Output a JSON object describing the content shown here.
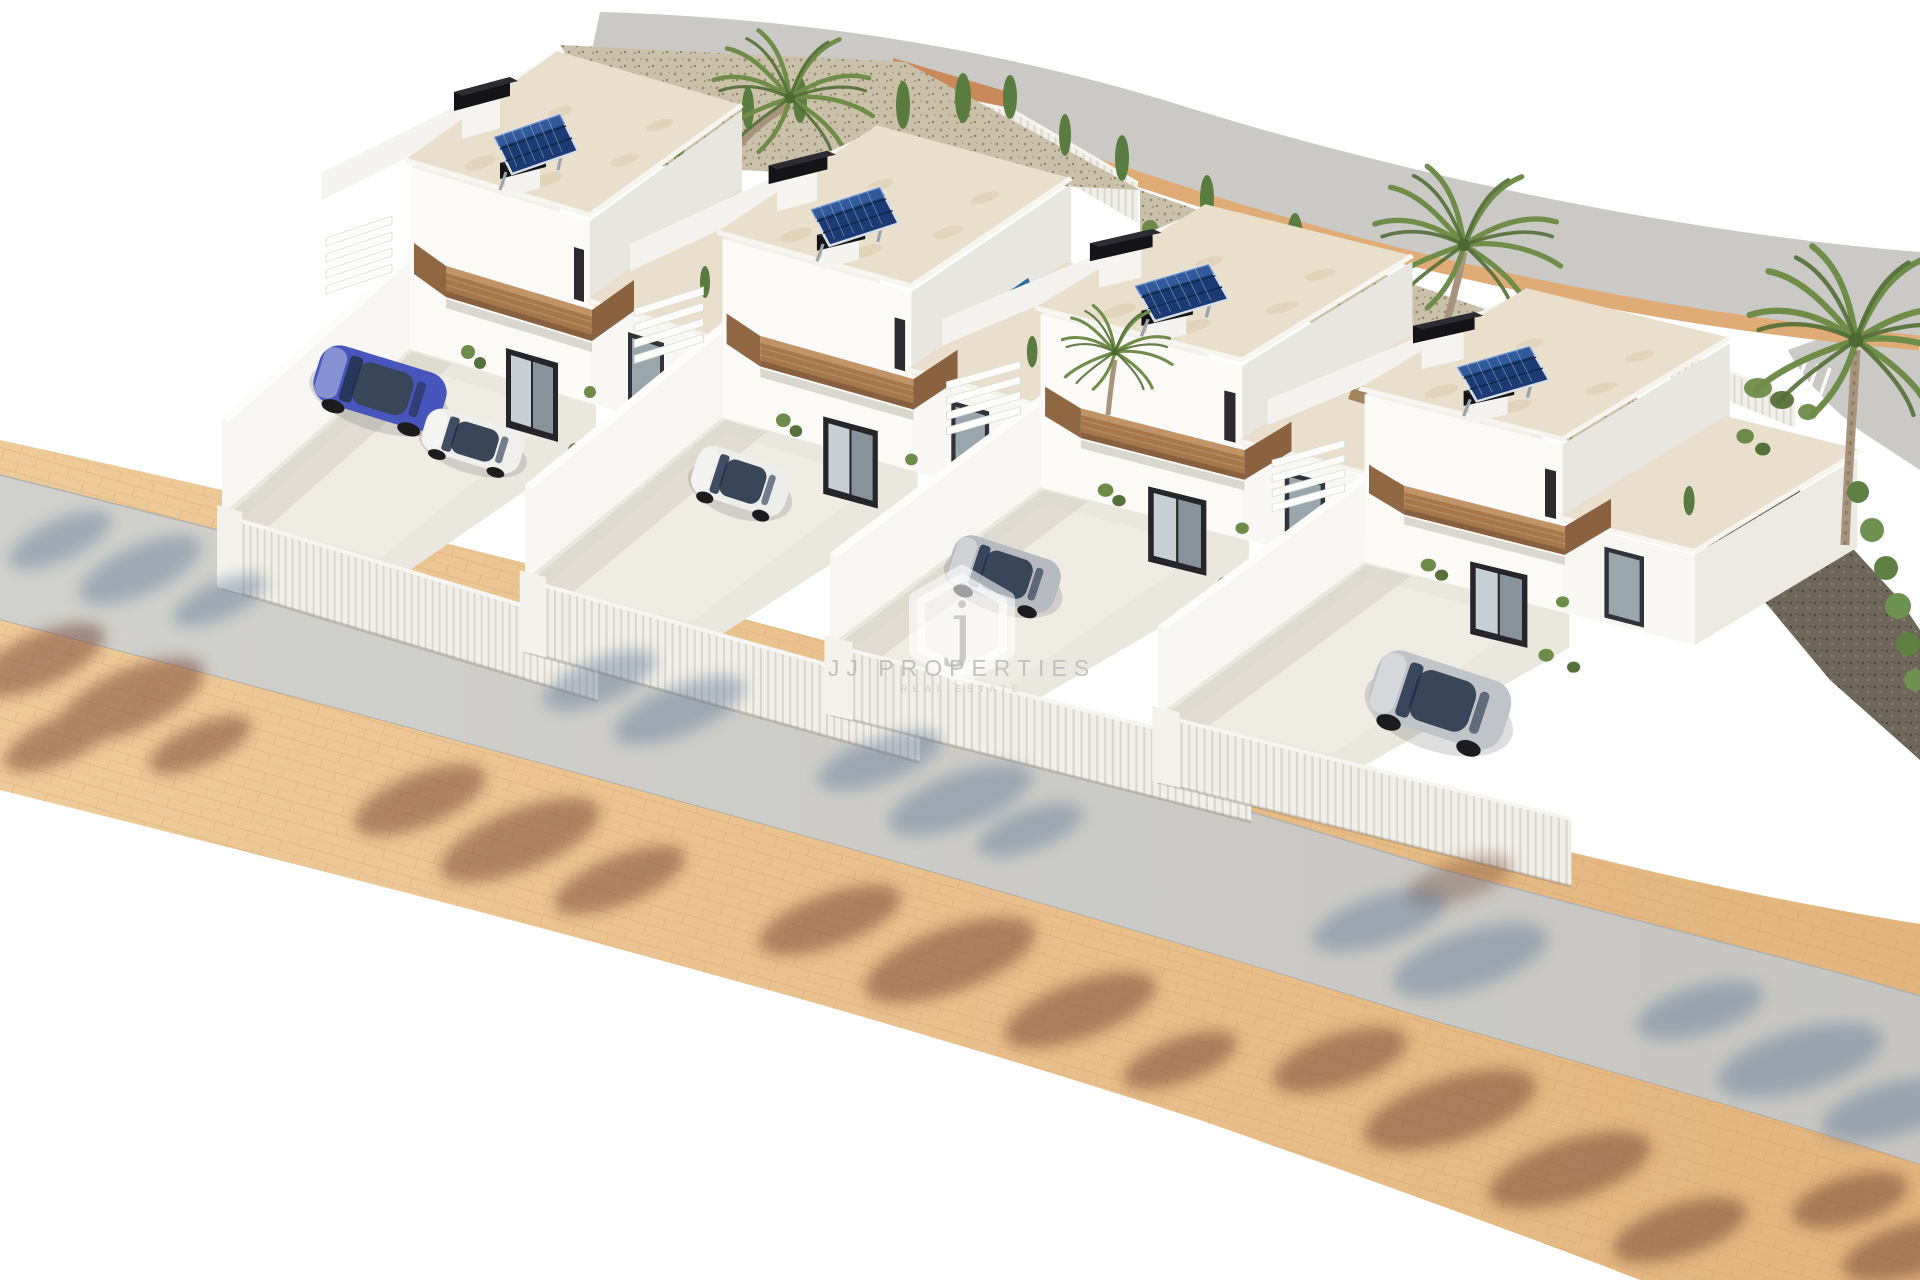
{
  "watermark": {
    "logo_letter": "j",
    "brand": "JJ PROPERTIES",
    "tagline": "REAL ESTATE"
  },
  "scene": {
    "type": "3d-architectural-render",
    "description": "Aerial 3D render of four modern white two-storey villas in a row, each with rooftop solar panels, black chimney caps, wooden balcony bands, private walled courtyards with parked cars, palm trees and gravel gardens; a curved road runs behind and a tan paved sidewalk, asphalt road and second sidewalk with tree shadows cross the foreground",
    "villa_count": 4,
    "solar_panels_per_villa": 1,
    "cars_visible": [
      "blue",
      "white",
      "white",
      "silver",
      "silver"
    ],
    "palm_trees_visible": 4,
    "pools_visible": 2,
    "colors": {
      "background": "#ffffff",
      "villa_wall": "#fbfaf7",
      "villa_wall_shade": "#eceae4",
      "roof_travertine": "#e9dfcc",
      "wood_balcony": "#a5774b",
      "solar_panel": "#1c3b74",
      "chimney_cap": "#141418",
      "rear_road": "#cbc9c6",
      "curb": "#dfab76",
      "terracotta_bank": "#c9895a",
      "sidewalk_tan": "#ebc493",
      "front_road_gray": "#cdcdc9",
      "shadow_brown": "#6e4130",
      "shadow_blue": "#5e7694",
      "pool_water": "#2e6b9e",
      "palm_green": "#6f8d49",
      "gravel": "#cbc0a9"
    }
  }
}
